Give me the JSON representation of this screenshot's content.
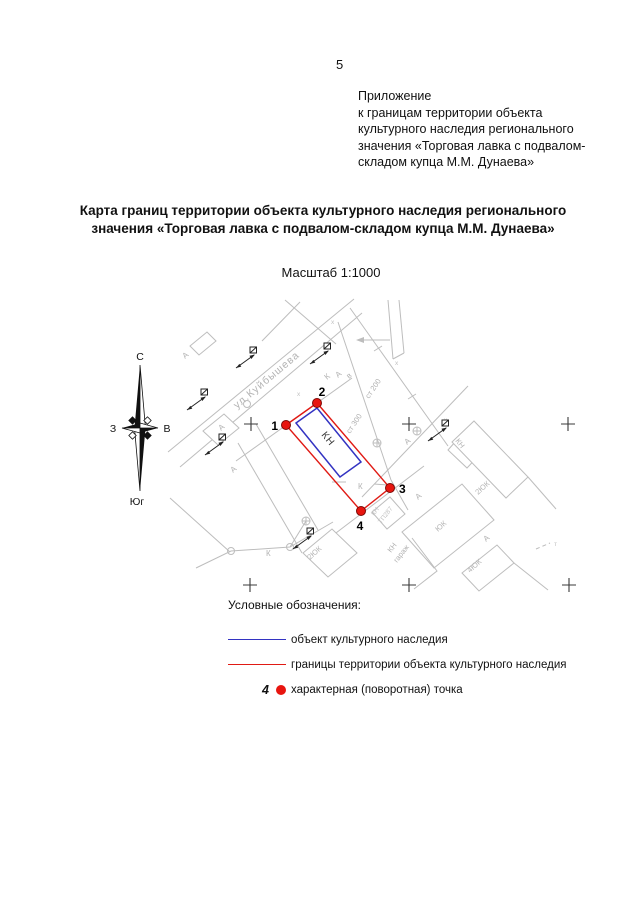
{
  "page": {
    "number": "5",
    "appendix_lines": [
      "Приложение",
      "к границам территории объекта",
      "культурного наследия регионального",
      "значения «Торговая лавка с подвалом-",
      "складом купца М.М. Дунаева»"
    ],
    "title_lines": [
      "Карта границ территории объекта культурного наследия регионального",
      "значения  «Торговая лавка с подвалом-складом купца М.М. Дунаева»"
    ],
    "scale_label": "Масштаб 1:1000"
  },
  "compass": {
    "north": "С",
    "south": "Юг",
    "west": "З",
    "east": "В"
  },
  "map": {
    "street_label": "ул.Куйбышева",
    "points": [
      {
        "label": "1"
      },
      {
        "label": "2"
      },
      {
        "label": "3"
      },
      {
        "label": "4"
      }
    ],
    "labels": {
      "kn_object": "КН",
      "kn_small": "КН",
      "yuk_big": "ЮК",
      "yuk2_top_right": "2ЮК",
      "yuk2_bottom_left": "2ЮК",
      "yuk4": "4ЮК",
      "kn_tp_line1": "КН",
      "kn_tp_line2": "ТП287",
      "kn_garage_line1": "КН",
      "kn_garage_line2": "гараж",
      "st200": "ст 200",
      "st300": "ст 300",
      "letter_a": "А",
      "letter_k": "К",
      "letter_v": "в",
      "letter_x": "х",
      "letter_t": "т"
    },
    "colors": {
      "boundary_line": "#e01a14",
      "object_line": "#3333c2",
      "point_fill": "#e8150f",
      "point_stroke": "#7c0a06",
      "background_lines": "#bdbdbd"
    }
  },
  "legend": {
    "heading": "Условные обозначения:",
    "items": [
      {
        "label": "объект культурного наследия"
      },
      {
        "label": "границы территории объекта культурного наследия"
      },
      {
        "point_number": "4",
        "label": "характерная (поворотная) точка"
      }
    ]
  }
}
